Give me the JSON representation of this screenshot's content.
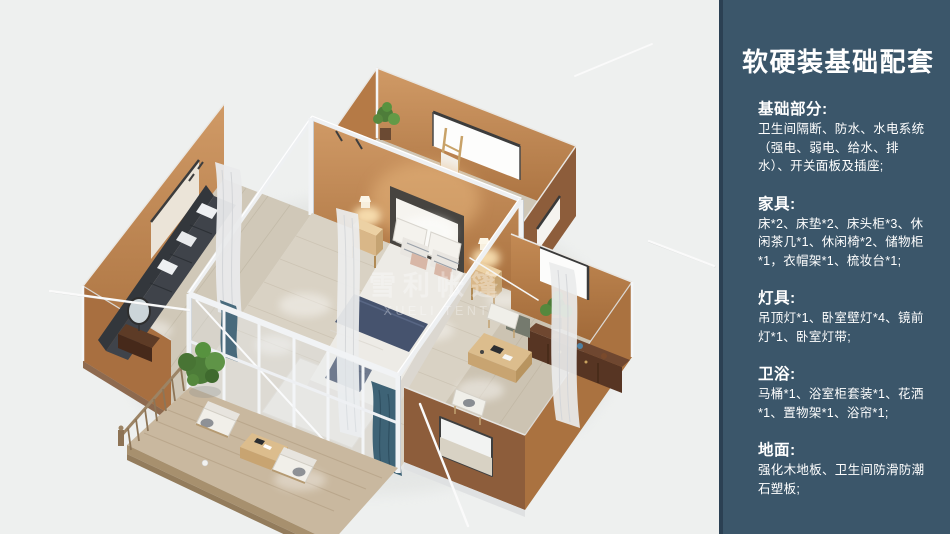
{
  "panel": {
    "title": "软硬装基础配套",
    "sections": [
      {
        "heading": "基础部分:",
        "body": "卫生间隔断、防水、水电系统（强电、弱电、给水、排水）、开关面板及插座;"
      },
      {
        "heading": "家具:",
        "body": "床*2、床垫*2、床头柜*3、休闲茶几*1、休闲椅*2、储物柜*1，衣帽架*1、梳妆台*1;"
      },
      {
        "heading": "灯具:",
        "body": "吊顶灯*1、卧室壁灯*4、镜前灯*1、卧室灯带;"
      },
      {
        "heading": "卫浴:",
        "body": "马桶*1、浴室柜套装*1、花洒*1、置物架*1、浴帘*1;"
      },
      {
        "heading": "地面:",
        "body": "强化木地板、卫生间防滑防潮石塑板;"
      }
    ],
    "colors": {
      "background": "#3b566a",
      "edge": "#2b4053",
      "text": "#ffffff"
    }
  },
  "illustration": {
    "watermark_line1": "雪利帐篷",
    "watermark_line2": "XUELI TENT",
    "subject": "isometric 3D floor-plan render of a glamping tent suite",
    "colors": {
      "background": "#eef0ef",
      "wall_outer": "#8d5d3b",
      "wall_inner": "#c08a58",
      "floor_wood": "#d9d2c4",
      "deck_wood": "#c9b89f",
      "frame_white": "#f1f3f5",
      "bedding_navy": "#46536e",
      "plant_green": "#4c7b38",
      "sofa_charcoal": "#3f434a"
    }
  }
}
